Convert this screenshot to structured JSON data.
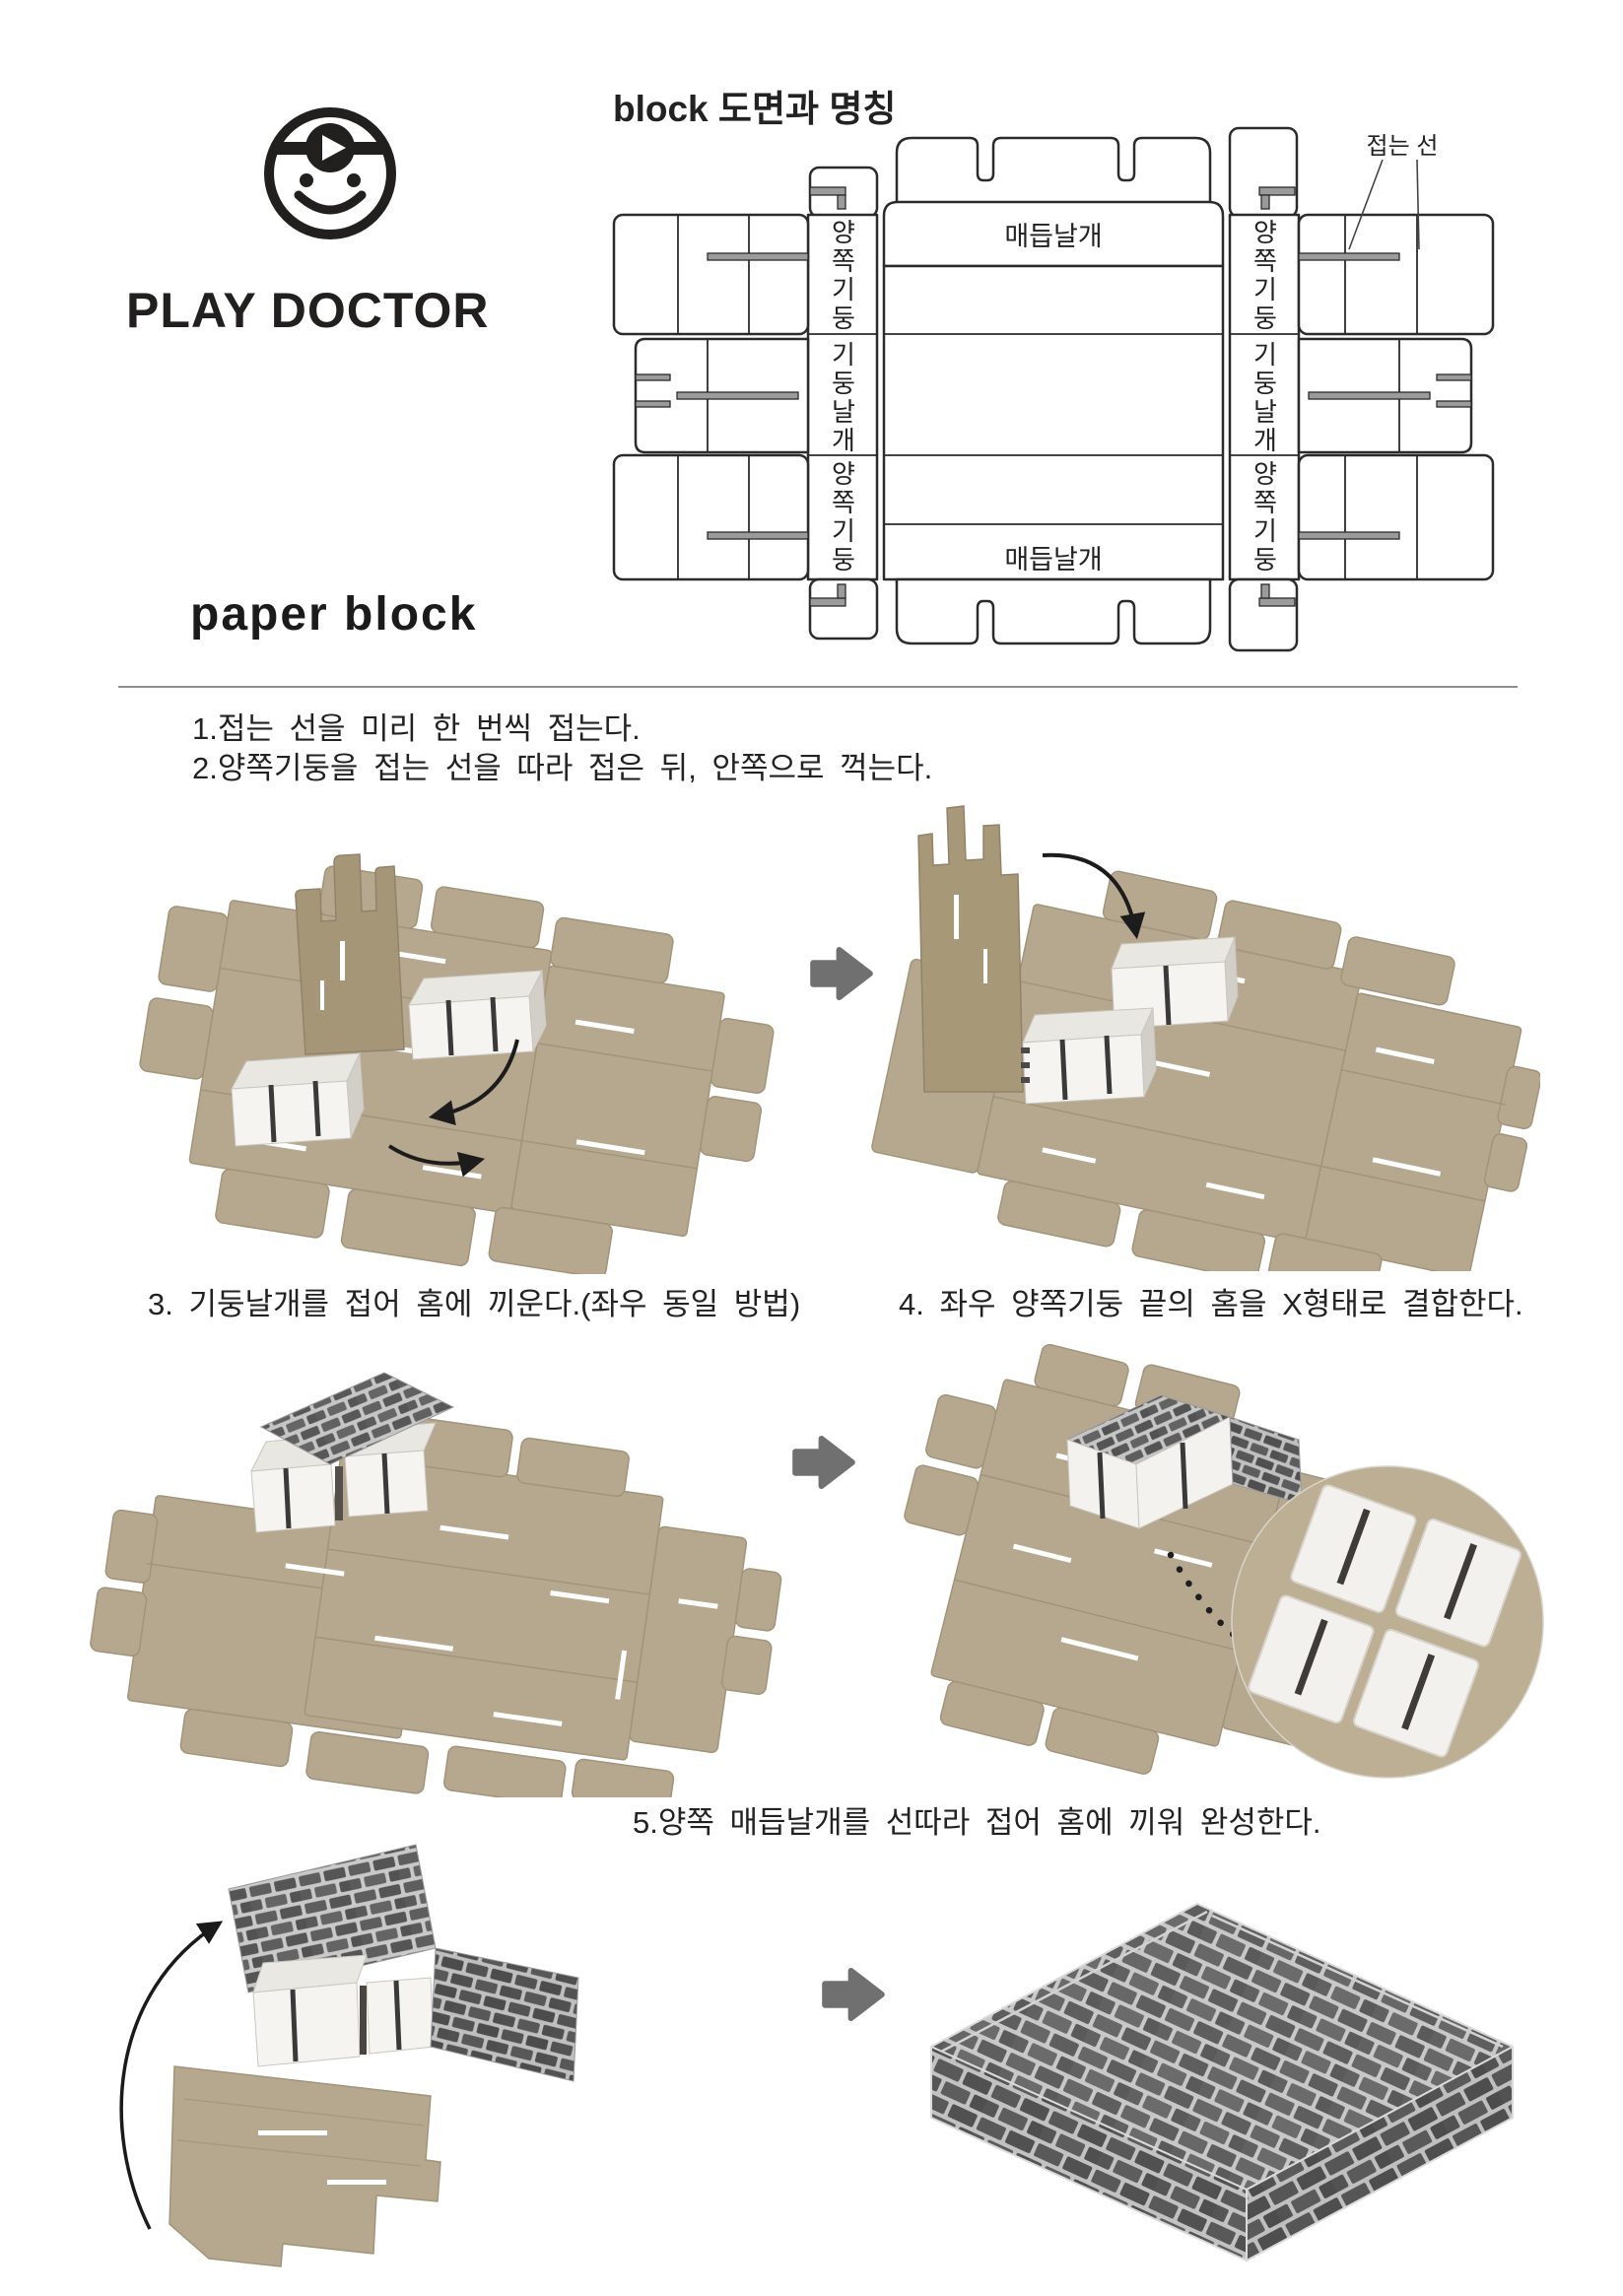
{
  "branding": {
    "name": "PLAY DOCTOR",
    "product": "paper block"
  },
  "diagram": {
    "title": "block 도면과 명칭",
    "fold_line_label": "접는 선",
    "column_labels": {
      "left_top": "양쪽기둥",
      "left_middle": "기둥날개",
      "left_bottom": "양쪽기둥",
      "right_top": "양쪽기둥",
      "right_middle": "기둥날개",
      "right_bottom": "양쪽기둥"
    },
    "band_labels": {
      "top": "매듭날개",
      "bottom": "매듭날개"
    }
  },
  "instructions": {
    "step1": "1.접는 선을 미리 한 번씩 접는다.",
    "step2": "2.양쪽기둥을 접는 선을 따라 접은 뒤, 안쪽으로 꺽는다.",
    "step3": "3. 기둥날개를 접어 홈에 끼운다.(좌우 동일 방법)",
    "step4": "4. 좌우 양쪽기둥 끝의 홈을 X형태로 결합한다.",
    "step5": "5.양쪽 매듭날개를 선따라 접어 홈에 끼워 완성한다."
  },
  "colors": {
    "cardboard": "#b6a88e",
    "cardboard_dark": "#a69678",
    "white_box": "#f4f3f0",
    "brick": "#5d5d5d",
    "mortar": "#c6c6c6",
    "arrow_gray": "#707070",
    "ink": "#1f1f1f"
  }
}
